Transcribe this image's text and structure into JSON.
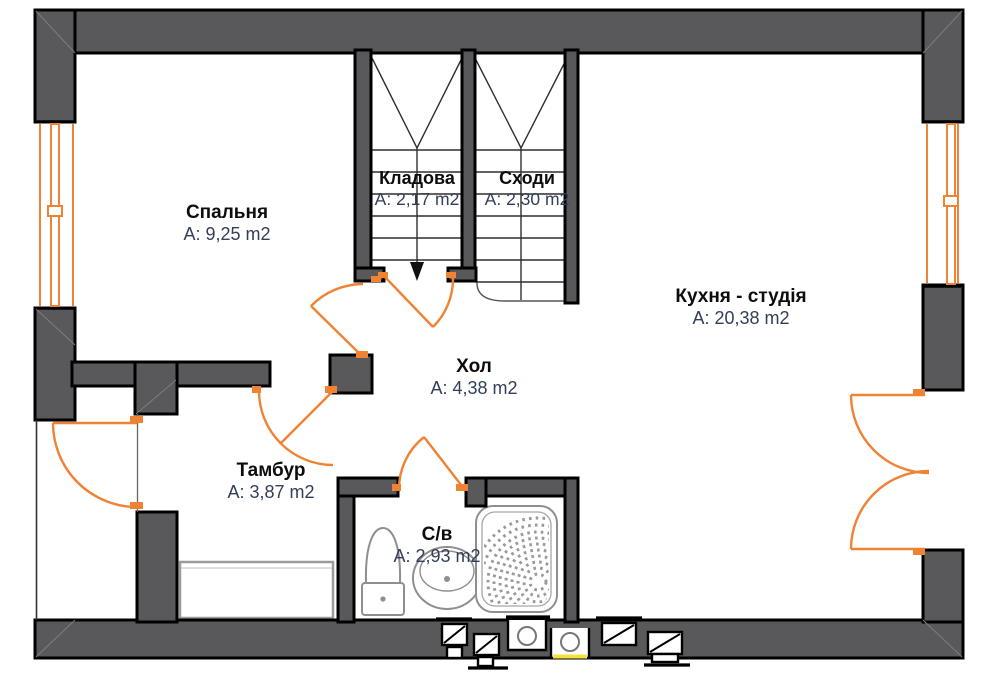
{
  "plan": {
    "type": "floor-plan",
    "language": "uk",
    "rooms": {
      "bedroom": {
        "name": "Спальня",
        "area": "A: 9,25 m2"
      },
      "storage": {
        "name": "Кладова",
        "area": "A: 2,17 m2"
      },
      "stairs": {
        "name": "Сходи",
        "area": "A: 2,30 m2"
      },
      "kitchen": {
        "name": "Кухня - студія",
        "area": "A: 20,38 m2"
      },
      "hall": {
        "name": "Хол",
        "area": "A: 4,38 m2"
      },
      "vestibule": {
        "name": "Тамбур",
        "area": "A: 3,87 m2"
      },
      "bathroom": {
        "name": "С/в",
        "area": "A: 2,93 m2"
      }
    },
    "colors": {
      "wall_fill": "#59595b",
      "wall_outline": "#000000",
      "door_window_accent": "#f08233",
      "room_name_text": "#0d0d0d",
      "area_text": "#333f58",
      "fixture_line": "#909090",
      "gas_mark": "#f3e23b",
      "background": "#ffffff"
    }
  }
}
